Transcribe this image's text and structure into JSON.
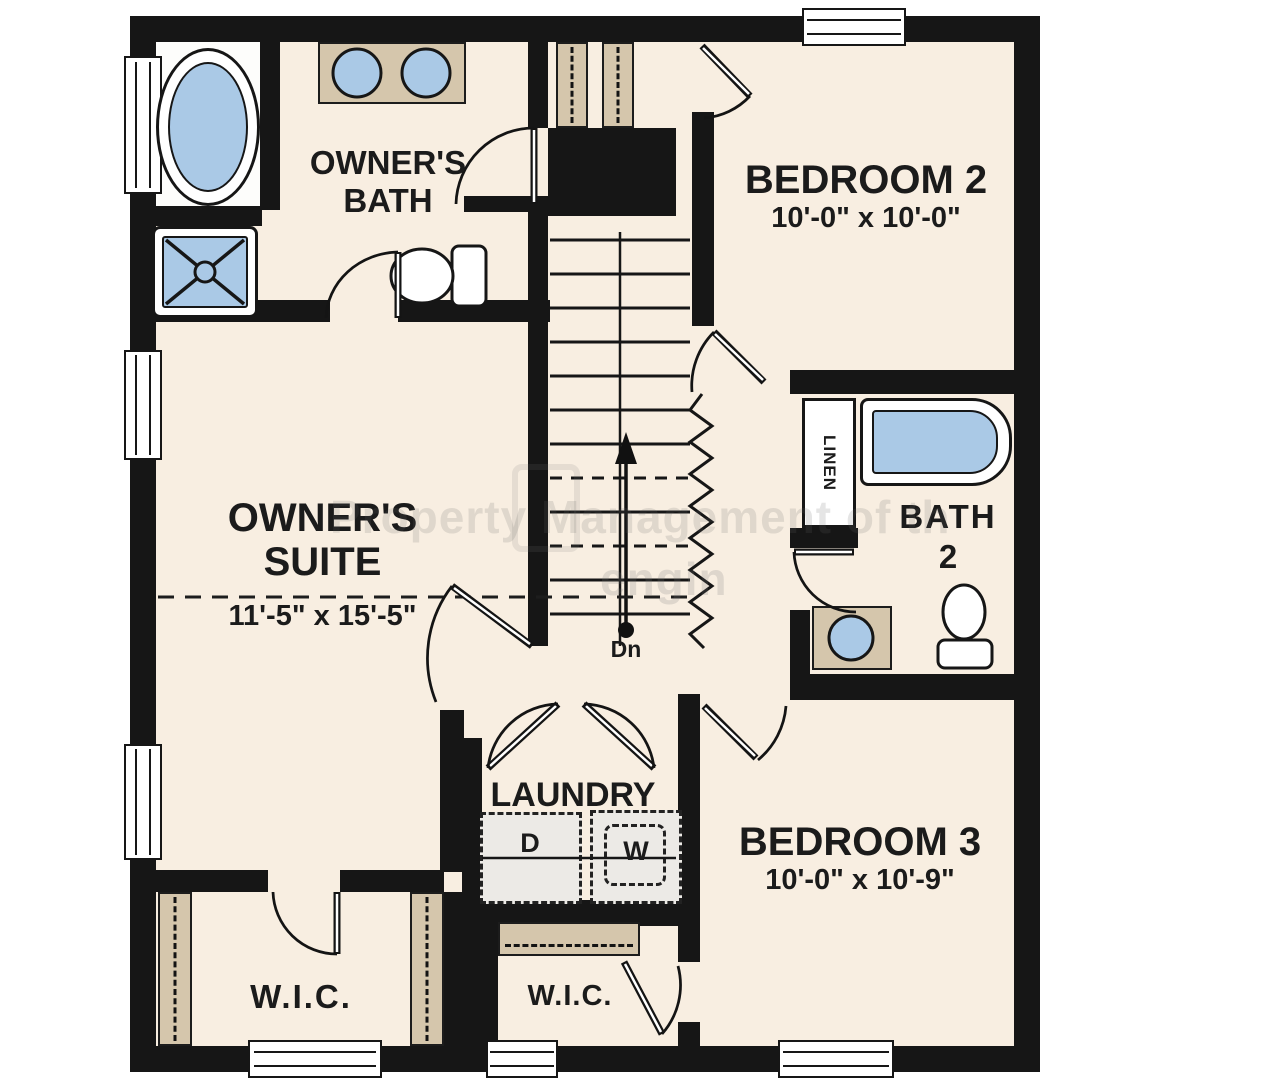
{
  "floor_plan": {
    "watermark": {
      "line1": "Property Management of th",
      "line2": "engin"
    },
    "rooms": {
      "owners_bath": {
        "name_line1": "OWNER'S",
        "name_line2": "BATH"
      },
      "bedroom_2": {
        "name": "BEDROOM 2",
        "dimensions": "10'-0\" x 10'-0\""
      },
      "owners_suite": {
        "name_line1": "OWNER'S",
        "name_line2": "SUITE",
        "dimensions": "11'-5\" x 15'-5\""
      },
      "bath_2": {
        "name_line1": "BATH",
        "name_line2": "2"
      },
      "laundry": {
        "name": "LAUNDRY",
        "dryer": "D",
        "washer": "W"
      },
      "bedroom_3": {
        "name": "BEDROOM 3",
        "dimensions": "10'-0\" x 10'-9\""
      },
      "owners_wic": {
        "name": "W.I.C."
      },
      "bedroom3_wic": {
        "name": "W.I.C."
      },
      "linen_closet": {
        "name": "LINEN"
      },
      "stairs": {
        "direction_label": "Dn"
      }
    },
    "colors": {
      "wall": "#161616",
      "floor_cream": "#f8eee1",
      "fixture_blue": "#aac9e6",
      "counter_tan": "#d5c6ac",
      "appliance_gray": "#eceae6"
    }
  }
}
